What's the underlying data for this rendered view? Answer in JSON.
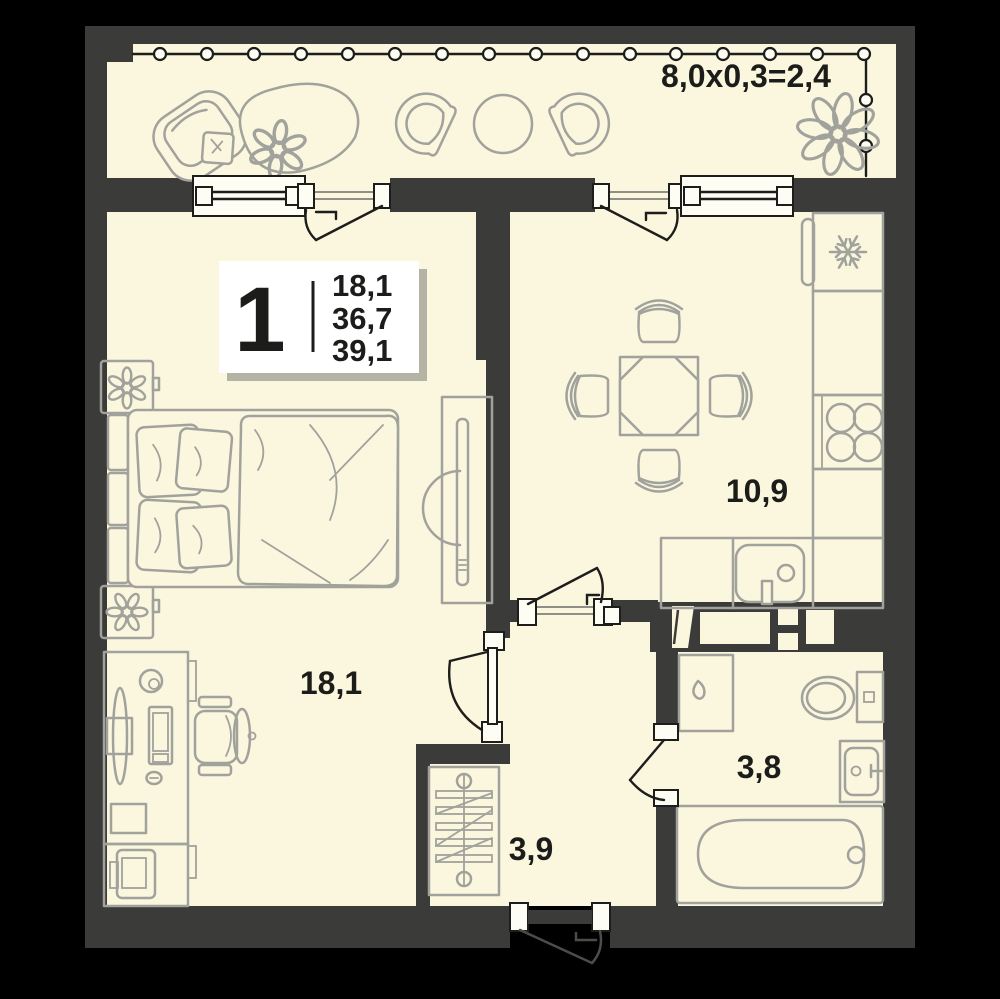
{
  "floor_plan": {
    "badge": {
      "rooms_count": "1",
      "area_living": "18,1",
      "area_total": "36,7",
      "area_total_with_balcony": "39,1"
    },
    "labels": {
      "balcony_dimensions": "8,0x0,3=2,4",
      "kitchen": "10,9",
      "bedroom": "18,1",
      "hallway": "3,9",
      "bathroom": "3,8"
    },
    "icons": {
      "fridge": "snowflake-icon"
    },
    "colors": {
      "background": "#000000",
      "wall": "#3b3b39",
      "floor": "#faf7de",
      "furniture_outline": "#a2a29c",
      "line_dark": "#1d1d1b",
      "window_fill": "#fdfdf4",
      "text": "#1c1c1a"
    }
  }
}
